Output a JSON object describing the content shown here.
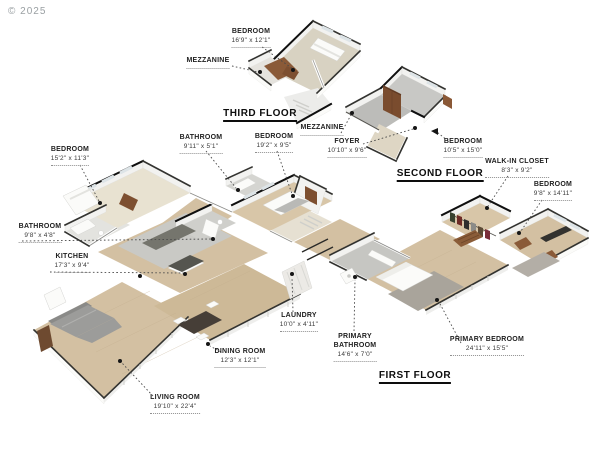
{
  "watermark": "© 2025",
  "floor_titles": {
    "third": "THIRD FLOOR",
    "second": "SECOND FLOOR",
    "first": "FIRST FLOOR"
  },
  "labels": {
    "bedroom_third": {
      "name": "BEDROOM",
      "dims": "16'9\" x 12'1\""
    },
    "mezzanine_third": {
      "name": "MEZZANINE"
    },
    "bathroom_hall": {
      "name": "BATHROOM",
      "dims": "9'11\" x 5'1\""
    },
    "bedroom_19": {
      "name": "BEDROOM",
      "dims": "19'2\" x 9'5\""
    },
    "mezzanine_second": {
      "name": "MEZZANINE"
    },
    "foyer": {
      "name": "FOYER",
      "dims": "10'10\" x 9'6\""
    },
    "bedroom_second": {
      "name": "BEDROOM",
      "dims": "10'5\" x 15'0\""
    },
    "walk_in_closet": {
      "name": "WALK-IN CLOSET",
      "dims": "8'3\" x 9'2\""
    },
    "bedroom_right": {
      "name": "BEDROOM",
      "dims": "9'8\" x 14'11\""
    },
    "bedroom_left": {
      "name": "BEDROOM",
      "dims": "15'2\" x 11'3\""
    },
    "bathroom_left": {
      "name": "BATHROOM",
      "dims": "9'8\" x 4'8\""
    },
    "kitchen": {
      "name": "KITCHEN",
      "dims": "17'3\" x 9'4\""
    },
    "laundry": {
      "name": "LAUNDRY",
      "dims": "10'0\" x 4'11\""
    },
    "primary_bathroom": {
      "line1": "PRIMARY",
      "line2": "BATHROOM",
      "dims": "14'6\" x 7'0\""
    },
    "primary_bedroom": {
      "name": "PRIMARY BEDROOM",
      "dims": "24'11\" x 15'5\""
    },
    "dining_room": {
      "name": "DINING ROOM",
      "dims": "12'3\" x 12'1\""
    },
    "living_room": {
      "name": "LIVING ROOM",
      "dims": "19'10\" x 22'4\""
    }
  },
  "colors": {
    "wood_floor": "#d3c0a2",
    "carpet": "#e8e2d1",
    "tile": "#c8c8c5",
    "wall_cap": "#333330",
    "door_brown": "#7d4f30",
    "label_text": "#1e1e1e"
  }
}
